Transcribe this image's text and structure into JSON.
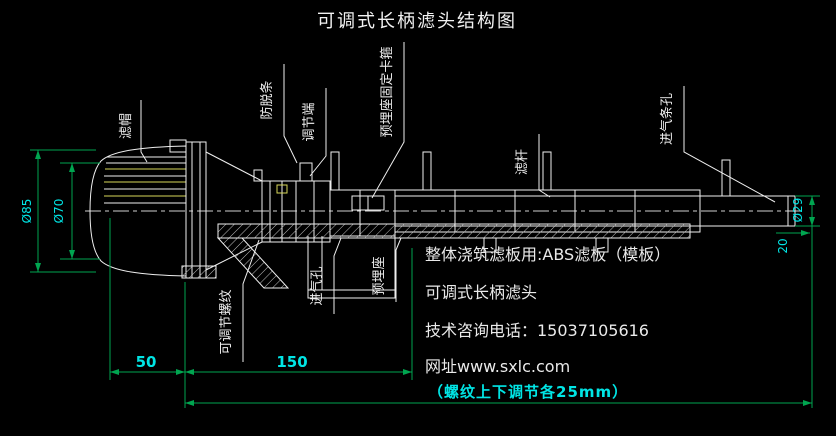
{
  "title": "可调式长柄滤头结构图",
  "part_labels": {
    "lv_mao": "滤帽",
    "fang_tuo_tiao": "防脱条",
    "tiao_jie_duan": "调节端",
    "ka_gu": "预埋座固定卡箍",
    "lv_gan": "滤杆",
    "jin_qi_tiao_kong": "进气条孔",
    "ke_tiao_jie_luo_wen": "可调节螺纹",
    "jin_qi_kong": "进气孔",
    "yu_mai_zuo": "预埋座"
  },
  "dimensions": {
    "dia85": "Ø85",
    "dia70": "Ø70",
    "dia29": "Ø29",
    "len20": "20",
    "len50": "50",
    "len150": "150",
    "note": "（螺纹上下调节各25mm）"
  },
  "info_block": {
    "line1": "整体浇筑滤板用:ABS滤板（模板）",
    "line2": "可调式长柄滤头",
    "line3": "技术咨询电话：15037105616",
    "line4": "网址www.sxlc.com"
  },
  "colors": {
    "background": "#000000",
    "drawing_line": "#efefef",
    "slot_highlight": "#d8d85a",
    "dimension_line": "#00a550",
    "dimension_text": "#00e5e5"
  }
}
